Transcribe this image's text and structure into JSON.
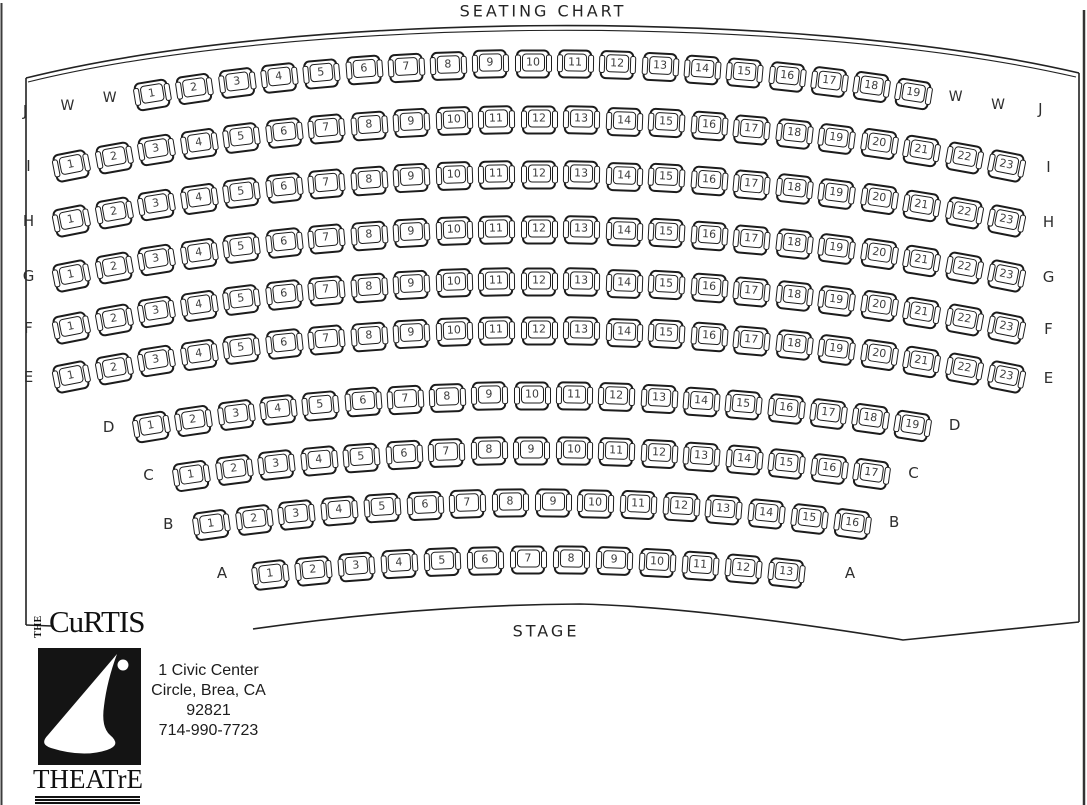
{
  "title": "SEATING CHART",
  "stage_label": "STAGE",
  "colors": {
    "ink": "#1c1c1c",
    "background": "#ffffff"
  },
  "rows": [
    {
      "label": "J",
      "left_extras": [
        "W",
        "W"
      ],
      "right_extras": [
        "W",
        "W"
      ],
      "seats": [
        1,
        2,
        3,
        4,
        5,
        6,
        7,
        8,
        9,
        10,
        11,
        12,
        13,
        14,
        15,
        16,
        17,
        18,
        19
      ]
    },
    {
      "label": "I",
      "left_extras": [],
      "right_extras": [],
      "seats": [
        1,
        2,
        3,
        4,
        5,
        6,
        7,
        8,
        9,
        10,
        11,
        12,
        13,
        14,
        15,
        16,
        17,
        18,
        19,
        20,
        21,
        22,
        23
      ]
    },
    {
      "label": "H",
      "left_extras": [],
      "right_extras": [],
      "seats": [
        1,
        2,
        3,
        4,
        5,
        6,
        7,
        8,
        9,
        10,
        11,
        12,
        13,
        14,
        15,
        16,
        17,
        18,
        19,
        20,
        21,
        22,
        23
      ]
    },
    {
      "label": "G",
      "left_extras": [],
      "right_extras": [],
      "seats": [
        1,
        2,
        3,
        4,
        5,
        6,
        7,
        8,
        9,
        10,
        11,
        12,
        13,
        14,
        15,
        16,
        17,
        18,
        19,
        20,
        21,
        22,
        23
      ]
    },
    {
      "label": "F",
      "left_extras": [],
      "right_extras": [],
      "seats": [
        1,
        2,
        3,
        4,
        5,
        6,
        7,
        8,
        9,
        10,
        11,
        12,
        13,
        14,
        15,
        16,
        17,
        18,
        19,
        20,
        21,
        22,
        23
      ]
    },
    {
      "label": "E",
      "left_extras": [],
      "right_extras": [],
      "seats": [
        1,
        2,
        3,
        4,
        5,
        6,
        7,
        8,
        9,
        10,
        11,
        12,
        13,
        14,
        15,
        16,
        17,
        18,
        19,
        20,
        21,
        22,
        23
      ]
    },
    {
      "label": "D",
      "left_extras": [],
      "right_extras": [],
      "seats": [
        1,
        2,
        3,
        4,
        5,
        6,
        7,
        8,
        9,
        10,
        11,
        12,
        13,
        14,
        15,
        16,
        17,
        18,
        19
      ]
    },
    {
      "label": "C",
      "left_extras": [],
      "right_extras": [],
      "seats": [
        1,
        2,
        3,
        4,
        5,
        6,
        7,
        8,
        9,
        10,
        11,
        12,
        13,
        14,
        15,
        16,
        17
      ]
    },
    {
      "label": "B",
      "left_extras": [],
      "right_extras": [],
      "seats": [
        1,
        2,
        3,
        4,
        5,
        6,
        7,
        8,
        9,
        10,
        11,
        12,
        13,
        14,
        15,
        16
      ]
    },
    {
      "label": "A",
      "left_extras": [],
      "right_extras": [],
      "seats": [
        1,
        2,
        3,
        4,
        5,
        6,
        7,
        8,
        9,
        10,
        11,
        12,
        13
      ]
    }
  ],
  "venue": {
    "logo_the": "THE",
    "logo_name": "CuRTIS",
    "logo_theatre": "THEATrE",
    "address_lines": [
      "1 Civic Center",
      "Circle, Brea, CA",
      "92821",
      "714-990-7723"
    ]
  }
}
